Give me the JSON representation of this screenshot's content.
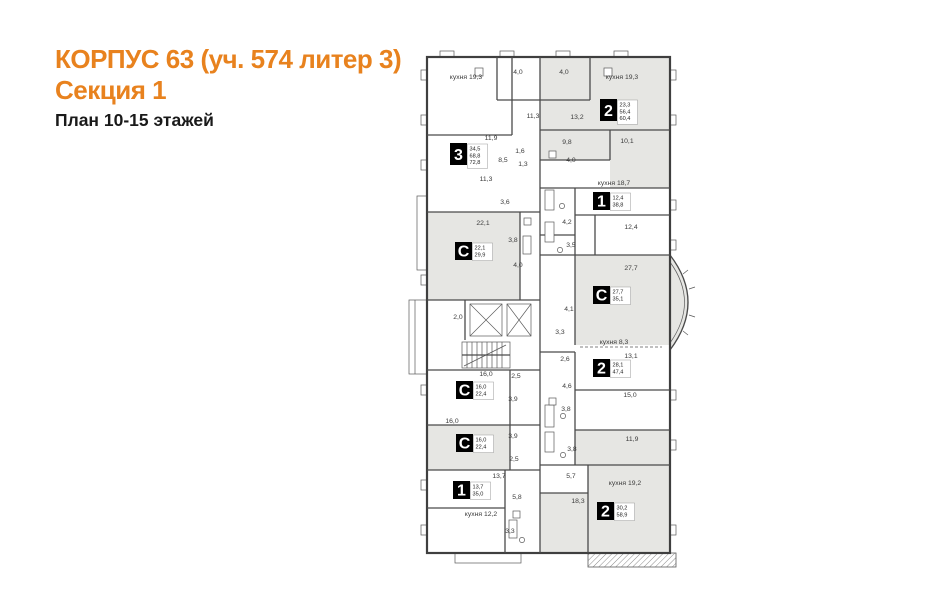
{
  "header": {
    "title_line1": "КОРПУС 63 (уч. 574 литер 3)",
    "title_line2": "Секция 1",
    "subtitle": "План 10-15 этажей"
  },
  "colors": {
    "accent": "#E8821E",
    "wall": "#3f3f3f",
    "room_shade": "#e6e6e3",
    "background": "#ffffff"
  },
  "plan": {
    "apartments": [
      {
        "type": "3",
        "areas": [
          "34,5",
          "68,8",
          "72,8"
        ],
        "x": 450,
        "y": 143
      },
      {
        "type": "2",
        "areas": [
          "23,3",
          "56,4",
          "60,4"
        ],
        "x": 600,
        "y": 99
      },
      {
        "type": "1",
        "areas": [
          "12,4",
          "38,8"
        ],
        "x": 593,
        "y": 192
      },
      {
        "type": "С",
        "areas": [
          "22,1",
          "29,9"
        ],
        "x": 455,
        "y": 242
      },
      {
        "type": "С",
        "areas": [
          "27,7",
          "35,1"
        ],
        "x": 593,
        "y": 286
      },
      {
        "type": "2",
        "areas": [
          "28,1",
          "47,4"
        ],
        "x": 593,
        "y": 359
      },
      {
        "type": "С",
        "areas": [
          "16,0",
          "22,4"
        ],
        "x": 456,
        "y": 381
      },
      {
        "type": "С",
        "areas": [
          "16,0",
          "22,4"
        ],
        "x": 456,
        "y": 434
      },
      {
        "type": "1",
        "areas": [
          "13,7",
          "35,0"
        ],
        "x": 453,
        "y": 481
      },
      {
        "type": "2",
        "areas": [
          "30,2",
          "58,9"
        ],
        "x": 597,
        "y": 502
      }
    ],
    "room_labels": [
      {
        "text": "кухня 19,3",
        "x": 466,
        "y": 79
      },
      {
        "text": "4,0",
        "x": 518,
        "y": 74
      },
      {
        "text": "4,0",
        "x": 564,
        "y": 74
      },
      {
        "text": "кухня 19,3",
        "x": 622,
        "y": 79
      },
      {
        "text": "11,3",
        "x": 533,
        "y": 118
      },
      {
        "text": "13,2",
        "x": 577,
        "y": 119
      },
      {
        "text": "11,9",
        "x": 491,
        "y": 140
      },
      {
        "text": "9,8",
        "x": 567,
        "y": 144
      },
      {
        "text": "10,1",
        "x": 627,
        "y": 143
      },
      {
        "text": "1,6",
        "x": 520,
        "y": 153
      },
      {
        "text": "8,5",
        "x": 503,
        "y": 162
      },
      {
        "text": "4,0",
        "x": 571,
        "y": 162
      },
      {
        "text": "1,3",
        "x": 523,
        "y": 166
      },
      {
        "text": "11,3",
        "x": 486,
        "y": 181
      },
      {
        "text": "кухня 18,7",
        "x": 614,
        "y": 185
      },
      {
        "text": "3,6",
        "x": 505,
        "y": 204
      },
      {
        "text": "22,1",
        "x": 483,
        "y": 225
      },
      {
        "text": "4,2",
        "x": 567,
        "y": 224
      },
      {
        "text": "12,4",
        "x": 631,
        "y": 229
      },
      {
        "text": "3,8",
        "x": 513,
        "y": 242
      },
      {
        "text": "3,5",
        "x": 571,
        "y": 247
      },
      {
        "text": "4,0",
        "x": 518,
        "y": 267
      },
      {
        "text": "27,7",
        "x": 631,
        "y": 270
      },
      {
        "text": "2,0",
        "x": 458,
        "y": 319
      },
      {
        "text": "4,1",
        "x": 569,
        "y": 311
      },
      {
        "text": "3,3",
        "x": 560,
        "y": 334
      },
      {
        "text": "кухня 8,3",
        "x": 614,
        "y": 344
      },
      {
        "text": "2,6",
        "x": 565,
        "y": 361
      },
      {
        "text": "13,1",
        "x": 631,
        "y": 358
      },
      {
        "text": "16,0",
        "x": 486,
        "y": 376
      },
      {
        "text": "2,5",
        "x": 516,
        "y": 378
      },
      {
        "text": "4,6",
        "x": 567,
        "y": 388
      },
      {
        "text": "3,9",
        "x": 513,
        "y": 401
      },
      {
        "text": "15,0",
        "x": 630,
        "y": 397
      },
      {
        "text": "16,0",
        "x": 452,
        "y": 423
      },
      {
        "text": "3,8",
        "x": 566,
        "y": 411
      },
      {
        "text": "3,9",
        "x": 513,
        "y": 438
      },
      {
        "text": "11,9",
        "x": 632,
        "y": 441
      },
      {
        "text": "2,5",
        "x": 514,
        "y": 461
      },
      {
        "text": "3,8",
        "x": 572,
        "y": 451
      },
      {
        "text": "13,7",
        "x": 499,
        "y": 478
      },
      {
        "text": "5,7",
        "x": 571,
        "y": 478
      },
      {
        "text": "кухня 19,2",
        "x": 625,
        "y": 485
      },
      {
        "text": "5,8",
        "x": 517,
        "y": 499
      },
      {
        "text": "18,3",
        "x": 578,
        "y": 503
      },
      {
        "text": "кухня 12,2",
        "x": 481,
        "y": 516
      },
      {
        "text": "3,3",
        "x": 510,
        "y": 533
      }
    ]
  }
}
